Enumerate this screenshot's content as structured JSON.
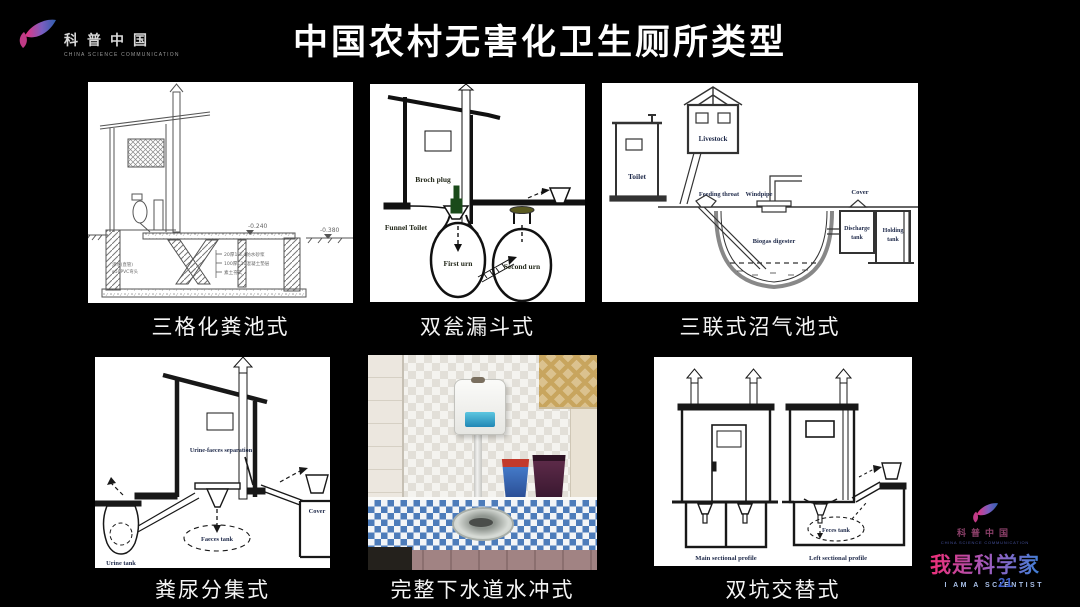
{
  "slide": {
    "title": "中国农村无害化卫生厕所类型",
    "page_number": "21"
  },
  "brand_top": {
    "name_cn": "科普中国",
    "name_en": "CHINA SCIENCE COMMUNICATION"
  },
  "brand_bottom": {
    "name_cn": "科普中国",
    "name_en": "CHINA SCIENCE COMMUNICATION",
    "slogan_cn": "我是科学家",
    "slogan_en": "I AM A SCIENTIST"
  },
  "colors": {
    "background": "#000000",
    "accent_pink": "#e8327e",
    "accent_blue": "#3f7fd6",
    "caption_text": "#f5f5f5"
  },
  "panels": {
    "septic": {
      "caption": "三格化粪池式",
      "elevation_mid": "-0.240",
      "elevation_right": "-0.380",
      "note_1": "20厚1:3.4防水砂浆",
      "note_2": "100厚C10混凝土垫层",
      "note_3": "素土夯实",
      "note_left_1": "渗水(直管)",
      "note_left_2": "φ50PVC弯头"
    },
    "urn": {
      "caption": "双瓮漏斗式",
      "label_plug": "Broch plug",
      "label_toilet": "Funnel Toilet",
      "label_first": "First urn",
      "label_second": "Second urn"
    },
    "biogas": {
      "caption": "三联式沼气池式",
      "label_toilet": "Toilet",
      "label_livestock": "Livestock",
      "label_feeding": "Feeding throat",
      "label_windpipe": "Windpipe",
      "label_cover": "Cover",
      "label_discharge_1": "Discharge",
      "label_discharge_2": "tank",
      "label_holding_1": "Holding",
      "label_holding_2": "tank",
      "label_digester": "Biogas digester"
    },
    "separation": {
      "caption": "粪尿分集式",
      "label_separation": "Urine-faeces separation",
      "label_urine": "Urine tank",
      "label_faeces": "Faeces tank",
      "label_cover": "Cover"
    },
    "flush": {
      "caption": "完整下水道水冲式"
    },
    "doublepit": {
      "caption": "双坑交替式",
      "label_feces": "Feces tank",
      "label_main": "Main sectional profile",
      "label_left": "Left sectional profile"
    }
  }
}
